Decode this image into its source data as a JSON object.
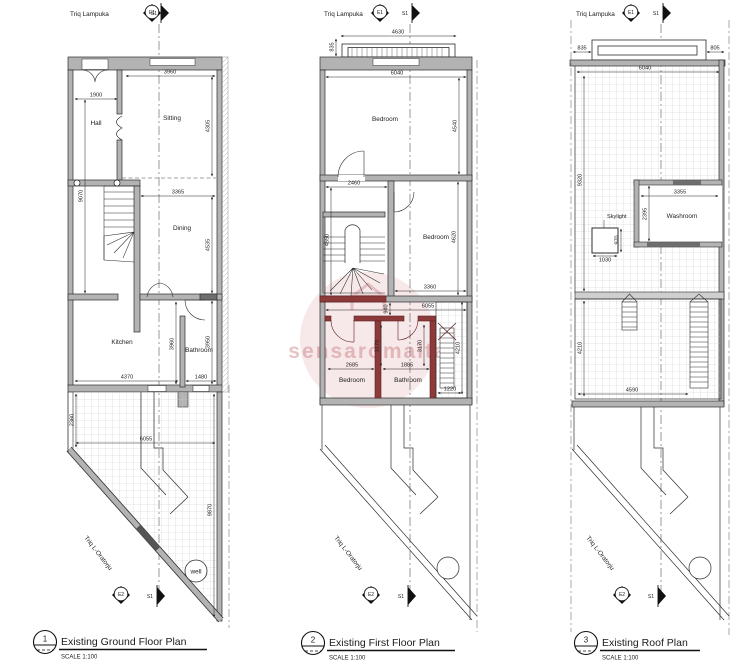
{
  "drawing": {
    "street_top": "Triq Lampuka",
    "street_side": "Triq L-Oratorju",
    "markers": {
      "e1": "E1",
      "e2": "E2",
      "s1": "S1"
    },
    "watermark": "sensaromalta",
    "colors": {
      "wall": "#b3b3b3",
      "red_wall": "#8d3a3a",
      "hatch": "#c9c9c9",
      "watermark_pink": "#c06268"
    },
    "plans": [
      {
        "number": "1",
        "title": "Existing Ground Floor Plan",
        "scale": "SCALE 1:100",
        "rooms": {
          "hall": "Hall",
          "sitting": "Sitting",
          "dining": "Dining",
          "kitchen": "Kitchen",
          "bathroom": "Bathroom"
        },
        "well": "well",
        "dims": {
          "sitting_w": "3960",
          "hall_w": "1900",
          "sitting_h": "4305",
          "left_h": "9070",
          "dining_w": "3365",
          "dining_h": "4535",
          "bath_side_h": "3960",
          "right_h": "3950",
          "kitchen_w": "4370",
          "bathroom_w": "1480",
          "yard_left_h": "2360",
          "yard_w": "6055",
          "yard_right_h": "9870"
        }
      },
      {
        "number": "2",
        "title": "Existing First Floor Plan",
        "scale": "SCALE 1:100",
        "rooms": {
          "bedroom_front": "Bedroom",
          "bedroom_mid": "Bedroom",
          "bedroom_rear": "Bedroom",
          "bathroom": "Bathroom"
        },
        "dims": {
          "balcony_w": "4630",
          "balcony_off": "835",
          "front_w": "6040",
          "front_h": "4540",
          "stair_w": "2460",
          "stair_h": "4550",
          "mid_h": "4620",
          "mid_w": "3360",
          "lower_w": "6055",
          "lower_off": "940",
          "bed_h": "3170",
          "bath_h": "3170",
          "bed_w": "2685",
          "bath_w": "1885",
          "terrace_h": "4210",
          "terrace_w": "1220"
        }
      },
      {
        "number": "3",
        "title": "Existing Roof Plan",
        "scale": "SCALE 1:100",
        "rooms": {
          "washroom": "Washroom"
        },
        "labels": {
          "skylight": "Skylight"
        },
        "dims": {
          "off_left": "835",
          "off_right": "805",
          "roof_w": "6040",
          "roof_h": "9320",
          "washroom_w": "3355",
          "washroom_h": "2395",
          "skylight_h": "970",
          "skylight_w": "1030",
          "lower_h": "4210",
          "lower_w": "4590"
        }
      }
    ]
  }
}
